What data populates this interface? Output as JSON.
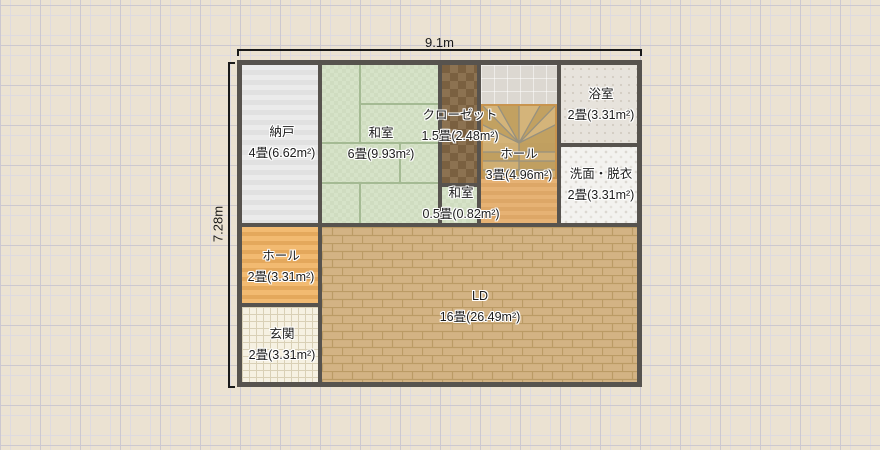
{
  "plan": {
    "dimensions": {
      "width": "9.1m",
      "height": "7.28m"
    },
    "rooms": [
      {
        "name": "納戸",
        "size": "4畳(6.62m²)"
      },
      {
        "name": "和室",
        "size": "6畳(9.93m²)"
      },
      {
        "name": "クローゼット",
        "size": "1.5畳(2.48m²)"
      },
      {
        "name": "ホール",
        "size": "3畳(4.96m²)"
      },
      {
        "name": "浴室",
        "size": "2畳(3.31m²)"
      },
      {
        "name": "洗面・脱衣",
        "size": "2畳(3.31m²)"
      },
      {
        "name": "和室",
        "size": "0.5畳(0.82m²)"
      },
      {
        "name": "ホール",
        "size": "2畳(3.31m²)"
      },
      {
        "name": "玄関",
        "size": "2畳(3.31m²)"
      },
      {
        "name": "LD",
        "size": "16畳(26.49m²)"
      }
    ],
    "colors": {
      "wall": "#57534e",
      "background": "#ebe2d2",
      "tatami": "#d3e0c4",
      "closet": "#85694a",
      "wood_hall": "#e8b069",
      "brick_ld": "#d3b384",
      "stairs_border": "#c8944e"
    }
  }
}
